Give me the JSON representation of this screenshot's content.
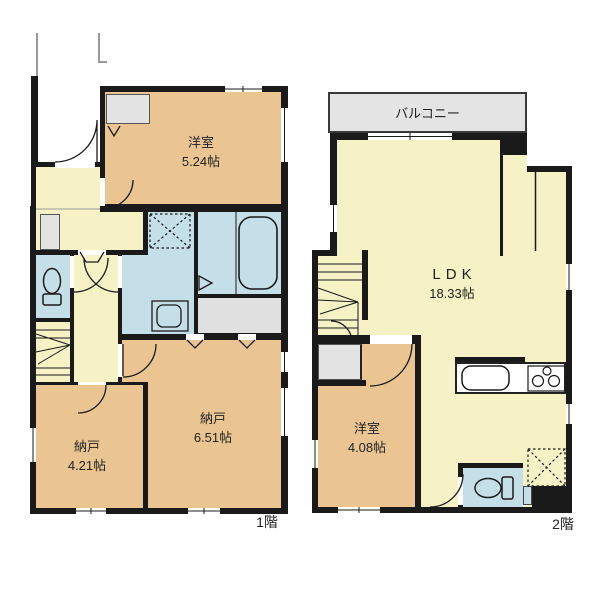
{
  "title": "2-story floor plan",
  "colors": {
    "wall": "#1a1a1a",
    "room_tan": "#EAC592",
    "hall_yellow": "#F7F2C6",
    "wet_blue": "#C5DFE9",
    "closet_gray": "#E3E3E3",
    "balcony_gray": "#E4E4E4"
  },
  "floor1": {
    "label": "1階",
    "western_room": {
      "name": "洋室",
      "area": "5.24帖"
    },
    "storage_large": {
      "name": "納戸",
      "area": "6.51帖"
    },
    "storage_small": {
      "name": "納戸",
      "area": "4.21帖"
    }
  },
  "floor2": {
    "label": "2階",
    "balcony_label": "バルコニー",
    "ldk": {
      "name": "LDK",
      "area": "18.33帖"
    },
    "western_room": {
      "name": "洋室",
      "area": "4.08帖"
    }
  }
}
